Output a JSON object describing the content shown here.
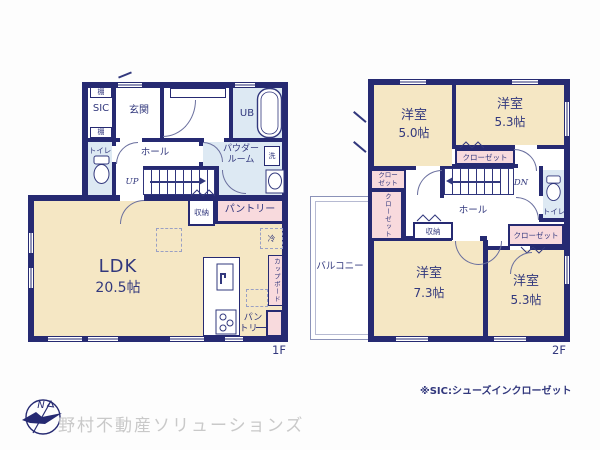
{
  "colors": {
    "wall": "#262a72",
    "room_cream": "#f5e7c4",
    "closet_pink": "#f8dadd",
    "wet_area_blue": "#dde9f3",
    "text_navy": "#32387d",
    "company_grey": "#c9c9c9"
  },
  "floor1": {
    "floor_label": "1F",
    "shelf_top": "棚",
    "sic": "SIC",
    "shelf_bottom": "棚",
    "genkan": "玄関",
    "ub": "UB",
    "toilet": "トイレ",
    "hall": "ホール",
    "powder_room": "パウダー\nルーム",
    "laundry": "洗",
    "up": "UP",
    "storage": "収納",
    "pantry": "パントリー",
    "ldk_name": "LDK",
    "ldk_size": "20.5帖",
    "fridge": "冷",
    "cupboard": "カップボード",
    "pantry_kitchen": "パン\nトリー"
  },
  "floor2": {
    "floor_label": "2F",
    "bedroom_nw_name": "洋室",
    "bedroom_nw_size": "5.0帖",
    "bedroom_ne_name": "洋室",
    "bedroom_ne_size": "5.3帖",
    "bedroom_sw_name": "洋室",
    "bedroom_sw_size": "7.3帖",
    "bedroom_se_name": "洋室",
    "bedroom_se_size": "5.3帖",
    "closet_mid": "クローゼット",
    "closet_w_upper": "クロー\nゼット",
    "closet_w_lower": "クローゼット",
    "closet_e": "クローゼット",
    "hall": "ホール",
    "storage": "収納",
    "toilet": "トイレ",
    "dn": "DN",
    "balcony": "バルコニー"
  },
  "footer": {
    "compass_n": "N",
    "company": "野村不動産ソリューションズ",
    "sic_note": "※SIC:シューズインクローゼット"
  }
}
